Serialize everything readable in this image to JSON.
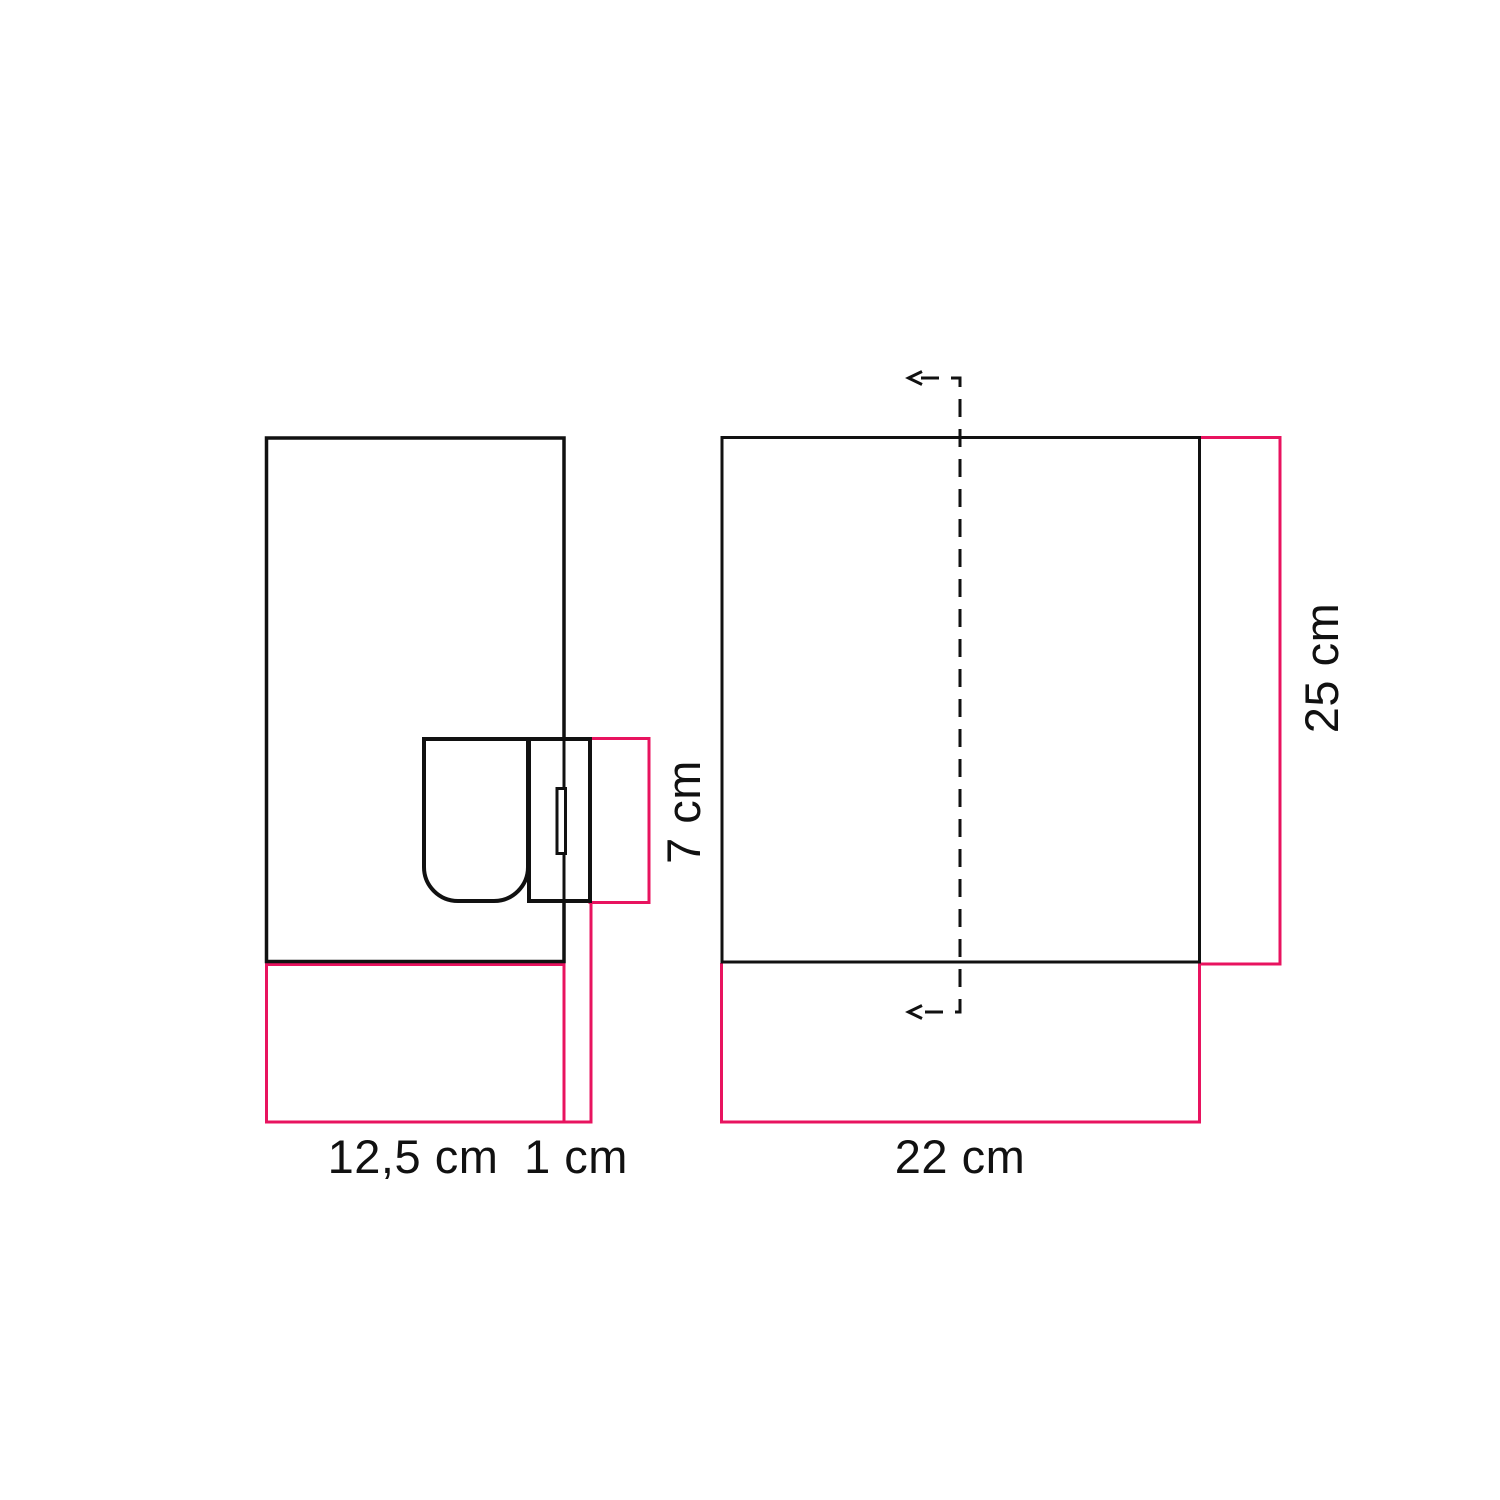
{
  "diagram": {
    "labels": {
      "side_width": "12,5 cm",
      "plate_depth": "1 cm",
      "socket_height": "7 cm",
      "front_width": "22 cm",
      "front_height": "25 cm"
    },
    "colors": {
      "outline": "#111111",
      "dimension": "#e8135f",
      "text": "#111111",
      "background": "#ffffff"
    }
  }
}
